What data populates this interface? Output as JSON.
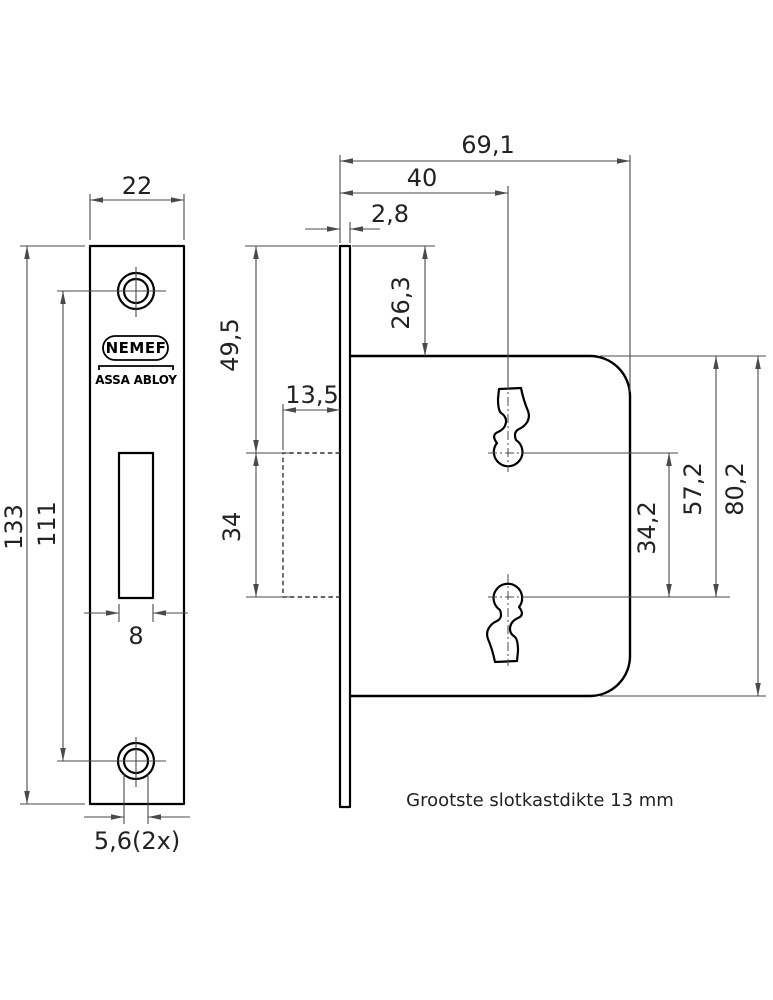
{
  "drawing": {
    "brand": {
      "name": "NEMEF",
      "group": "ASSA ABLOY"
    },
    "note": "Grootste slotkastdikte 13 mm",
    "dims": {
      "plate_width": "22",
      "plate_height": "133",
      "screw_spacing": "111",
      "bolt_slot_width": "8",
      "screw_hole": "5,6(2x)",
      "case_depth": "69,1",
      "backset": "40",
      "plate_thickness": "2,8",
      "top_to_case": "26,3",
      "top_to_slot": "49,5",
      "slot_depth": "13,5",
      "slot_height": "34",
      "keyhole_spacing": "34,2",
      "case_to_lower_keyhole": "57,2",
      "case_height": "80,2"
    }
  }
}
